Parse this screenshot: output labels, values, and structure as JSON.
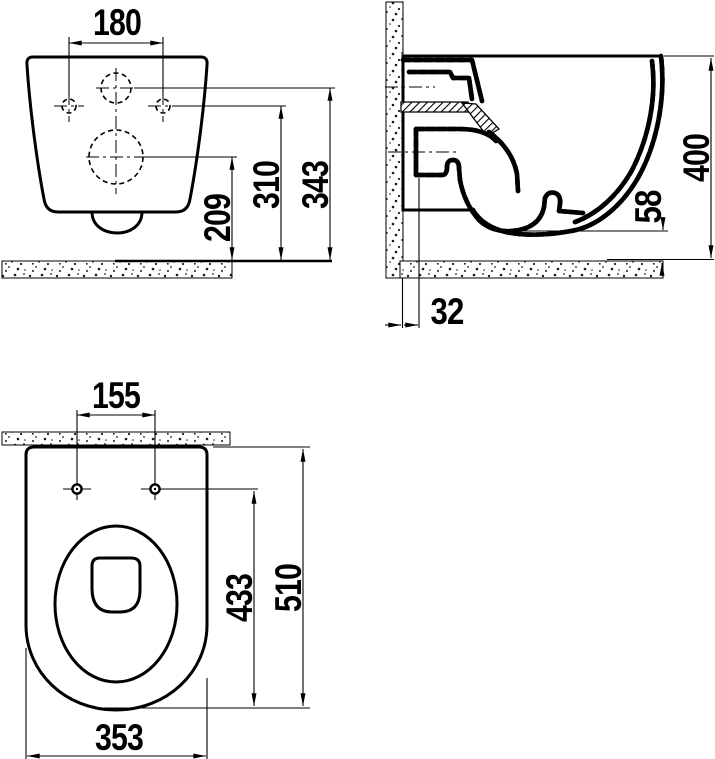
{
  "front_view": {
    "dim_hole_spacing": "180",
    "dim_total_height": "343",
    "dim_hole_height": "310",
    "dim_outlet_height": "209"
  },
  "side_view": {
    "dim_total_height": "400",
    "dim_trap_clearance": "58",
    "dim_wall_offset": "32"
  },
  "plan_view": {
    "dim_seat_hole_spacing": "155",
    "dim_total_depth": "510",
    "dim_hole_to_front_depth": "433",
    "dim_width": "353"
  },
  "colors": {
    "line": "#000000",
    "background": "#ffffff"
  }
}
